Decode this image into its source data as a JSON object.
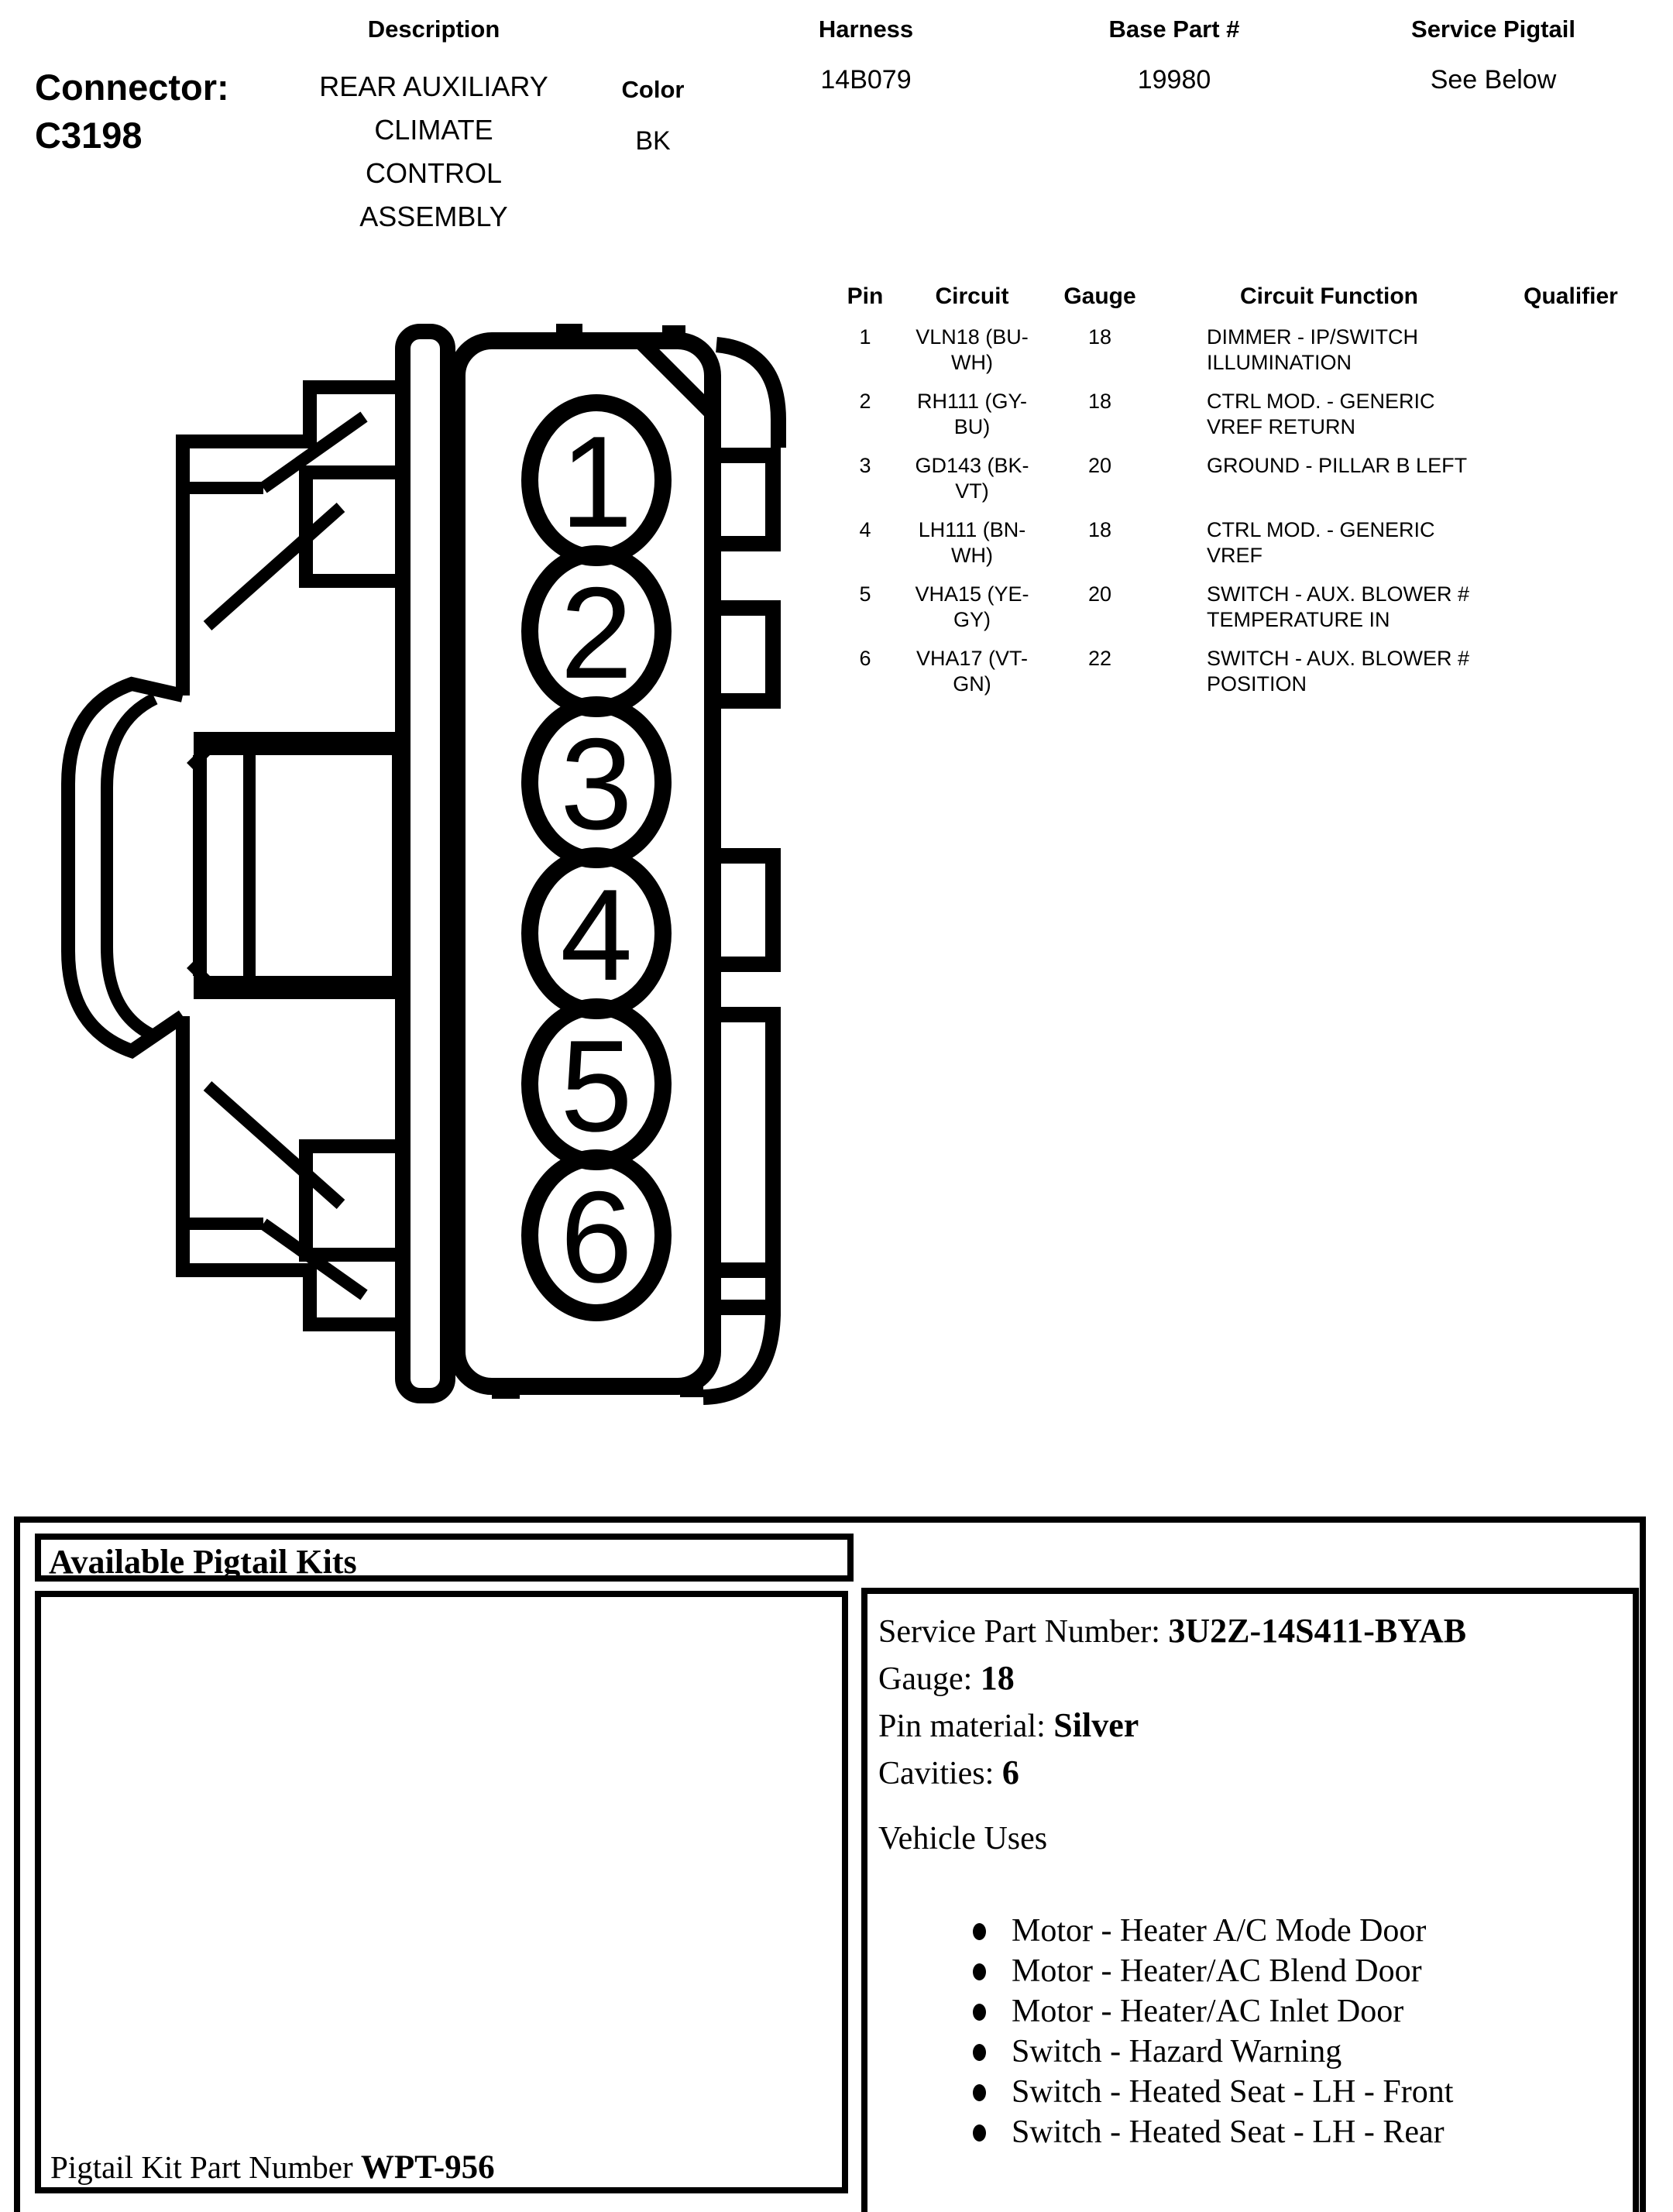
{
  "header": {
    "connector_label": "Connector:",
    "connector_id": "C3198",
    "description": {
      "label": "Description",
      "value_lines": [
        "REAR AUXILIARY",
        "CLIMATE",
        "CONTROL",
        "ASSEMBLY"
      ]
    },
    "color": {
      "label": "Color",
      "value": "BK"
    },
    "harness": {
      "label": "Harness",
      "value": "14B079"
    },
    "base_part": {
      "label": "Base Part #",
      "value": "19980"
    },
    "service_pigtail": {
      "label": "Service Pigtail",
      "value": "See Below"
    }
  },
  "diagram": {
    "name": "6-cavity connector face view",
    "pins": [
      "1",
      "2",
      "3",
      "4",
      "5",
      "6"
    ]
  },
  "pin_table": {
    "headers": [
      "Pin",
      "Circuit",
      "Gauge",
      "Circuit Function",
      "Qualifier"
    ],
    "rows": [
      {
        "pin": "1",
        "circuit": [
          "VLN18 (BU-",
          "WH)"
        ],
        "gauge": "18",
        "function": [
          "DIMMER - IP/SWITCH",
          "ILLUMINATION"
        ],
        "qualifier": ""
      },
      {
        "pin": "2",
        "circuit": [
          "RH111 (GY-",
          "BU)"
        ],
        "gauge": "18",
        "function": [
          "CTRL MOD. - GENERIC",
          "VREF RETURN"
        ],
        "qualifier": ""
      },
      {
        "pin": "3",
        "circuit": [
          "GD143 (BK-",
          "VT)"
        ],
        "gauge": "20",
        "function": [
          "GROUND - PILLAR B LEFT",
          ""
        ],
        "qualifier": ""
      },
      {
        "pin": "4",
        "circuit": [
          "LH111 (BN-",
          "WH)"
        ],
        "gauge": "18",
        "function": [
          "CTRL MOD. - GENERIC",
          "VREF"
        ],
        "qualifier": ""
      },
      {
        "pin": "5",
        "circuit": [
          "VHA15 (YE-",
          "GY)"
        ],
        "gauge": "20",
        "function": [
          "SWITCH - AUX. BLOWER #",
          "TEMPERATURE IN"
        ],
        "qualifier": ""
      },
      {
        "pin": "6",
        "circuit": [
          "VHA17 (VT-",
          "GN)"
        ],
        "gauge": "22",
        "function": [
          "SWITCH - AUX. BLOWER #",
          "POSITION"
        ],
        "qualifier": ""
      }
    ]
  },
  "pigtail": {
    "title": "Available Pigtail Kits",
    "service_part_label": "Service Part Number:",
    "service_part_value": "3U2Z-14S411-BYAB",
    "gauge_label": "Gauge:",
    "gauge_value": "18",
    "pin_material_label": "Pin material:",
    "pin_material_value": "Silver",
    "cavities_label": "Cavities:",
    "cavities_value": "6",
    "vehicle_uses_title": "Vehicle Uses",
    "vehicle_uses": [
      "Motor - Heater A/C Mode Door",
      "Motor - Heater/AC Blend Door",
      "Motor - Heater/AC Inlet Door",
      "Switch - Hazard Warning",
      "Switch - Heated Seat - LH - Front",
      "Switch - Heated Seat - LH - Rear"
    ],
    "kit_label": "Pigtail Kit Part Number",
    "kit_value": "WPT-956"
  }
}
